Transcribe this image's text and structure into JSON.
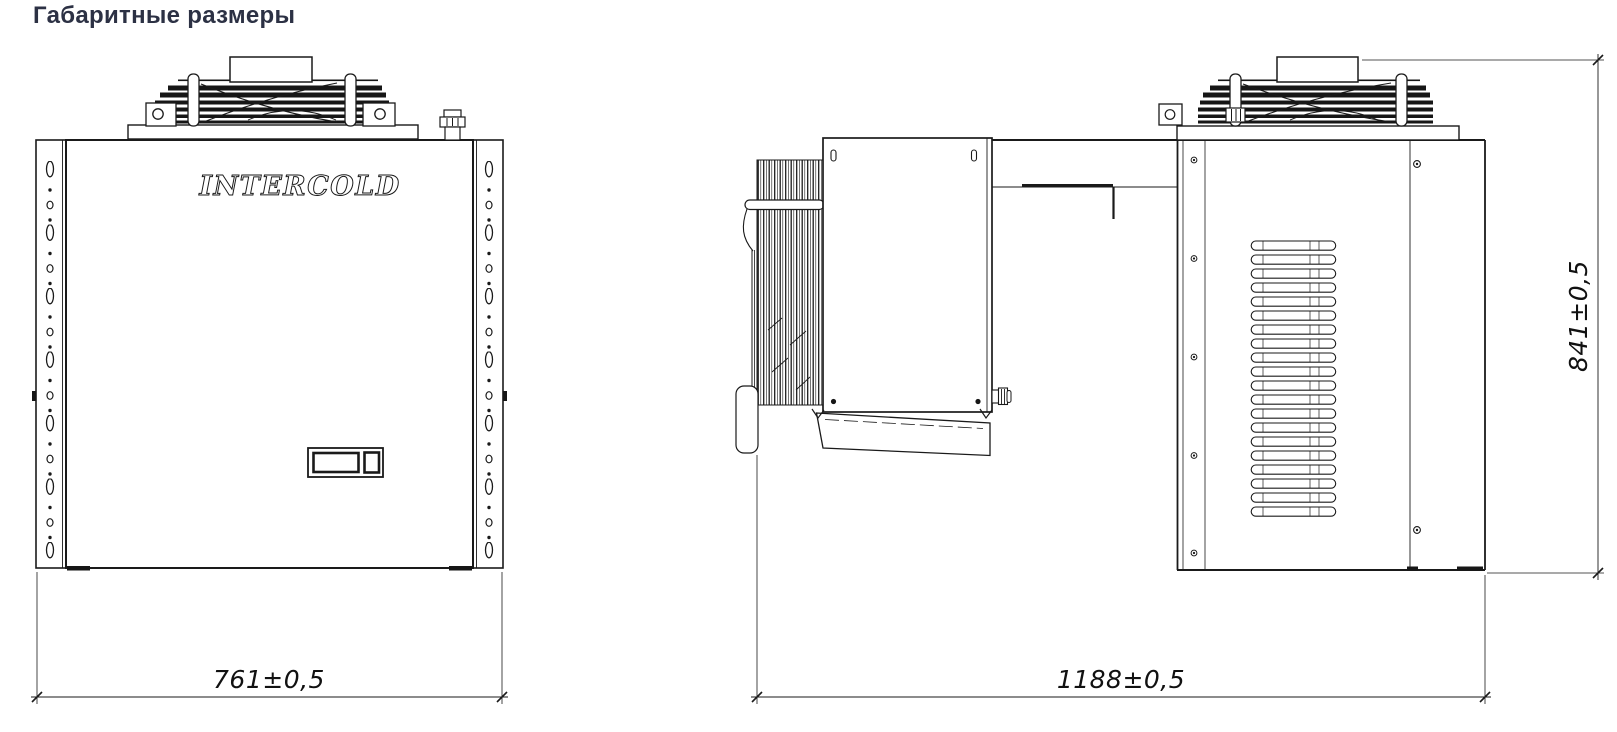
{
  "header": {
    "title": "Габаритные размеры",
    "title_color": "#2c3144"
  },
  "drawing": {
    "line_color": "#1a1a1a",
    "logo": "INTERCOLD",
    "dimensions": {
      "front_width": "761±0,5",
      "side_depth": "1188±0,5",
      "side_height": "841±0,5"
    }
  }
}
